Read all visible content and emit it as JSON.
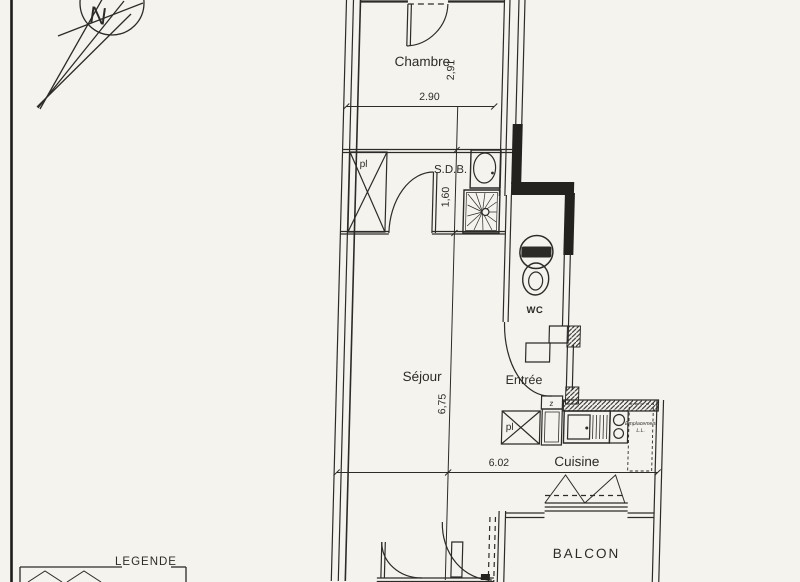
{
  "colors": {
    "background": "#f4f3ee",
    "ink": "#2d2b28"
  },
  "compass": {
    "north_label": "N"
  },
  "labels": {
    "chambre": "Chambre",
    "sdb": "S.D.B.",
    "wc": "WC",
    "sejour": "Séjour",
    "entree": "Entrée",
    "cuisine": "Cuisine",
    "balcon": "BALCON",
    "legende": "LEGENDE",
    "closet_upper": "pl",
    "closet_kitchen": "pl",
    "duct": "z",
    "washer_line1": "Emplacement",
    "washer_line2": "L.L."
  },
  "dimensions": {
    "chambre_width": "2.90",
    "chambre_depth": "2,91",
    "sdb_width": "1,60",
    "sejour_length": "6,75",
    "cuisine_length": "6.02"
  }
}
